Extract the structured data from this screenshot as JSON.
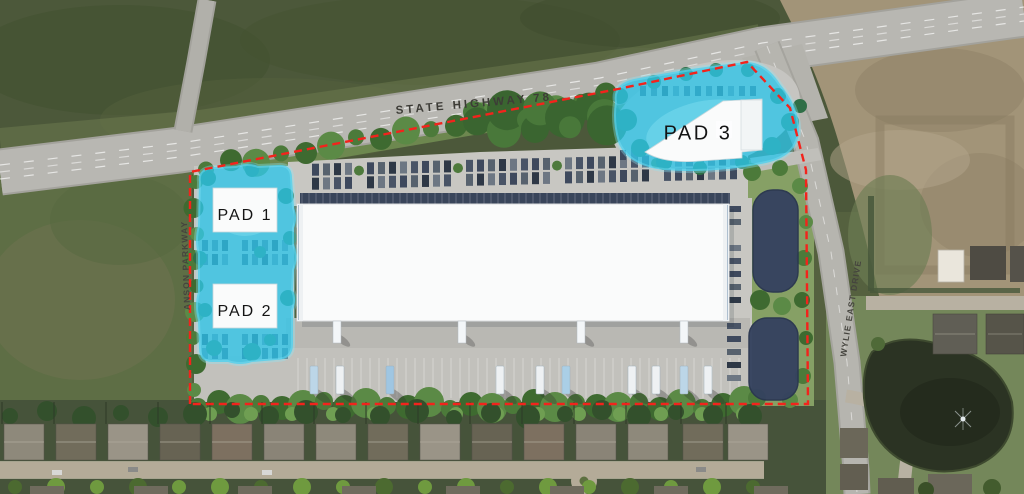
{
  "site_plan": {
    "pads": [
      {
        "label": "PAD 1"
      },
      {
        "label": "PAD 2"
      },
      {
        "label": "PAD 3"
      }
    ],
    "roads": [
      {
        "name": "STATE HIGHWAY 78"
      },
      {
        "name": "ANSON PARKWAY"
      },
      {
        "name": "WYLIE EAST DRIVE"
      }
    ],
    "colors": {
      "pad_highlight": "#2ec5e9",
      "boundary_line": "#f3231c",
      "building_footprint": "#fafbfb",
      "detention_pond": "#35425f"
    }
  }
}
